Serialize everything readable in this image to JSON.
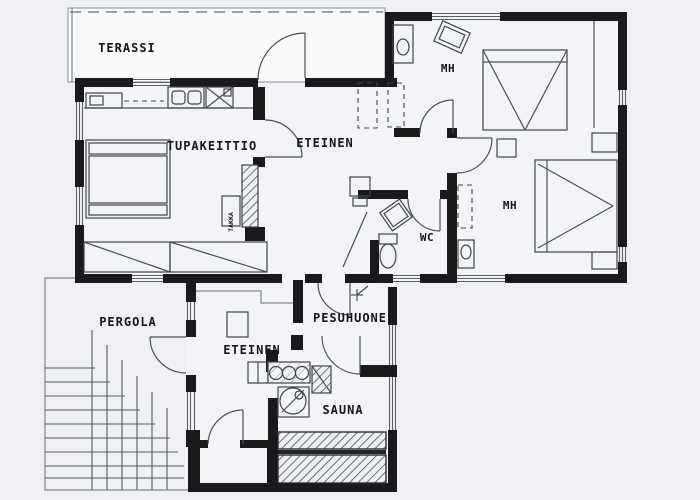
{
  "document": {
    "type": "architectural-floor-plan"
  },
  "rooms": {
    "terassi": {
      "label": "TERASSI"
    },
    "tupakeittio": {
      "label": "TUPAKEITTIO"
    },
    "eteinen_upper": {
      "label": "ETEINEN"
    },
    "mh_top": {
      "label": "MH"
    },
    "mh_right": {
      "label": "MH"
    },
    "wc": {
      "label": "WC"
    },
    "pergola": {
      "label": "PERGOLA"
    },
    "eteinen_lower": {
      "label": "ETEINEN"
    },
    "pesuhuone": {
      "label": "PESUHUONE"
    },
    "sauna": {
      "label": "SAUNA"
    }
  },
  "fixtures": {
    "takka_label": "TAKKA"
  },
  "colors": {
    "wall": "#1a1a1c",
    "thin_line": "#4a4f57",
    "paper": "#eef0f4",
    "room_fill": "#f3f4f8",
    "terrace_fill": "#f8f9fb"
  }
}
